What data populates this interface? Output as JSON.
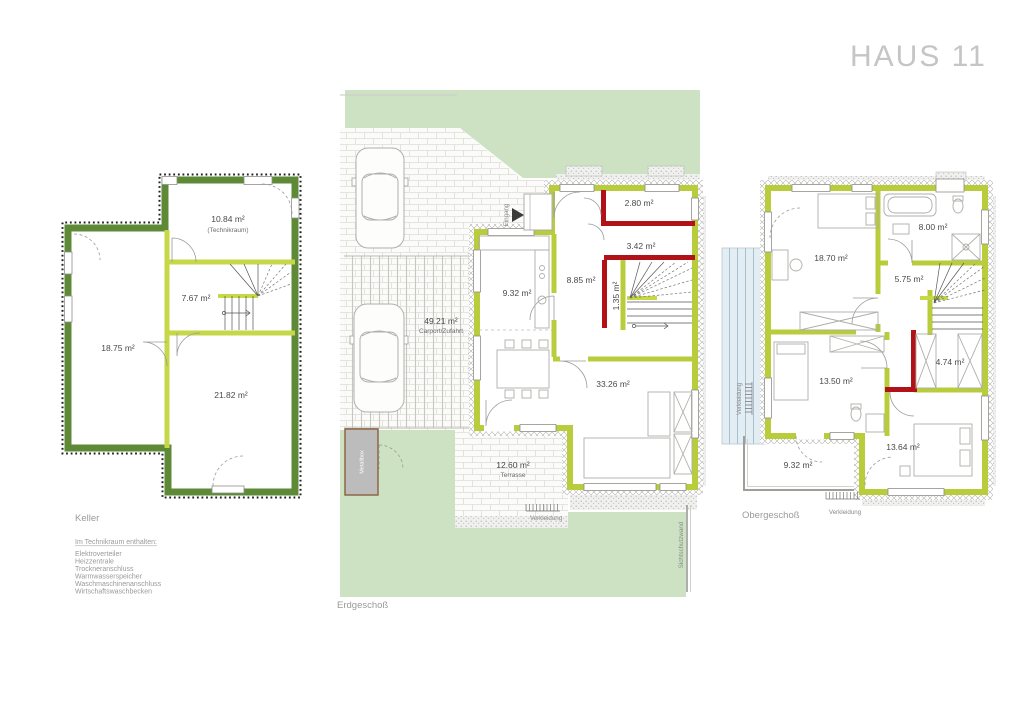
{
  "title": "HAUS 11",
  "colors": {
    "accent_wall": "#b8cc3c",
    "keller_wall": "#5e8a38",
    "highlight_wall": "#b01218",
    "garden": "#cde2c3",
    "glass": "#e3edf4"
  },
  "floors": {
    "keller": {
      "label": "Keller",
      "rooms": {
        "technikraum": {
          "area": "10.84 m²",
          "name": "(Technikraum)"
        },
        "flur": {
          "area": "7.67 m²"
        },
        "hobbyraum": {
          "area": "18.75 m²"
        },
        "kellerraum": {
          "area": "21.82 m²"
        }
      }
    },
    "erdgeschoss": {
      "label": "Erdgeschoß",
      "rooms": {
        "carport": {
          "area": "49.21 m²",
          "name": "Carport/Zufahrt"
        },
        "kueche": {
          "area": "9.32 m²"
        },
        "diele": {
          "area": "8.85 m²"
        },
        "wc": {
          "area": "2.80 m²"
        },
        "abstellraum": {
          "area": "3.42 m²"
        },
        "nische": {
          "area": "1.35 m²"
        },
        "wohnen_essen": {
          "area": "33.26 m²"
        },
        "terrasse": {
          "area": "12.60 m²",
          "name": "Terrasse"
        }
      },
      "annotations": {
        "eingang": "Eingang",
        "verkleidung": "Verkleidung",
        "sichtschutzwand": "Sichtschutzwand",
        "metallbox": "Metallbox"
      }
    },
    "obergeschoss": {
      "label": "Obergeschoß",
      "rooms": {
        "zimmer_gross": {
          "area": "18.70 m²"
        },
        "bad": {
          "area": "8.00 m²"
        },
        "flur": {
          "area": "5.75 m²"
        },
        "zimmer_mitte": {
          "area": "13.50 m²"
        },
        "ankleide": {
          "area": "4.74 m²"
        },
        "zimmer_unten": {
          "area": "13.64 m²"
        },
        "dachterrasse": {
          "area": "9.32 m²"
        }
      },
      "annotations": {
        "verkleidung_left": "Verkleidung",
        "verkleidung_bottom": "Verkleidung"
      }
    }
  },
  "legend": {
    "heading": "Im Technikraum enthalten:",
    "items": [
      "Elektroverteiler",
      "Heizzentrale",
      "Trockneranschluss",
      "Warmwasserspeicher",
      "Waschmaschinenanschluss",
      "Wirtschaftswaschbecken"
    ]
  }
}
